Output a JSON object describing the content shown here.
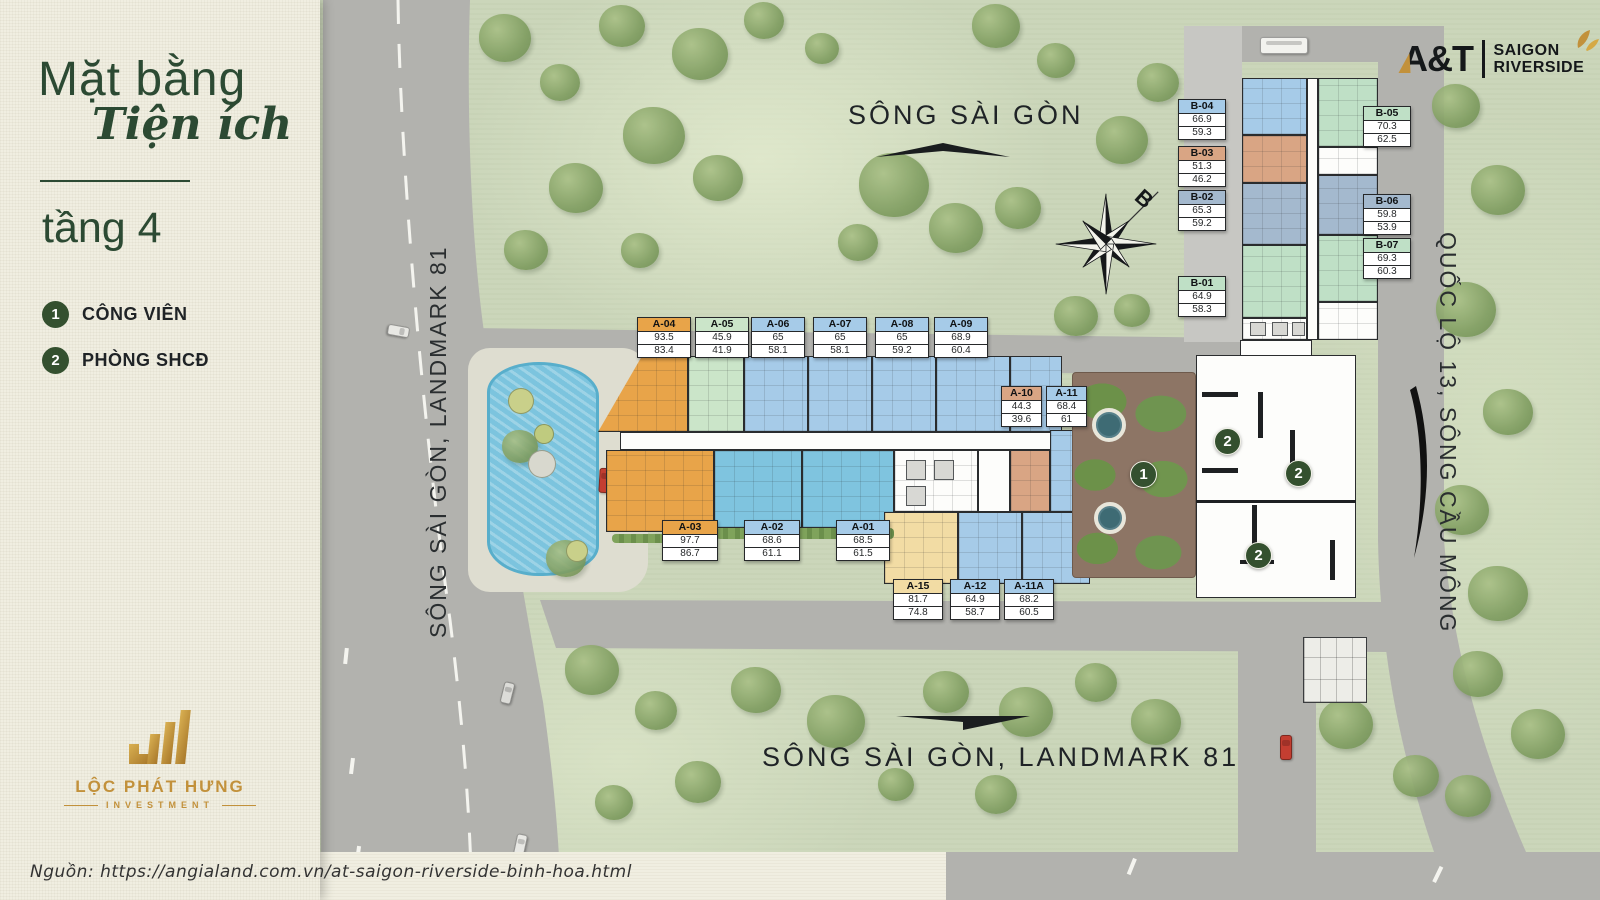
{
  "sidebar": {
    "title_main": "Mặt bằng",
    "title_script": "Tiện ích",
    "floor_label": "tầng 4",
    "legend": [
      {
        "num": "1",
        "label": "CÔNG VIÊN"
      },
      {
        "num": "2",
        "label": "PHÒNG SHCĐ"
      }
    ],
    "brand_name": "LỘC PHÁT HƯNG",
    "brand_sub": "INVESTMENT"
  },
  "source_note": "Nguồn:  https://angialand.com.vn/at-saigon-riverside-binh-hoa.html",
  "project_logo": {
    "mark": "A&T",
    "line1": "SAIGON",
    "line2": "RIVERSIDE"
  },
  "map_labels": {
    "river_top": "SÔNG SÀI GÒN",
    "river_bottom": "SÔNG SÀI GÒN, LANDMARK 81",
    "road_left": "SÔNG SÀI GÒN, LANDMARK 81",
    "road_right": "QUỐC LỘ 13, SÔNG CẦU MÔNG",
    "compass_north": "B"
  },
  "map_badges": [
    "1",
    "2",
    "2",
    "2"
  ],
  "units": [
    {
      "id": "A-04",
      "area1": "93.5",
      "area2": "83.4",
      "color": "orange"
    },
    {
      "id": "A-05",
      "area1": "45.9",
      "area2": "41.9",
      "color": "green"
    },
    {
      "id": "A-06",
      "area1": "65",
      "area2": "58.1",
      "color": "blue"
    },
    {
      "id": "A-07",
      "area1": "65",
      "area2": "58.1",
      "color": "blue"
    },
    {
      "id": "A-08",
      "area1": "65",
      "area2": "59.2",
      "color": "blue"
    },
    {
      "id": "A-09",
      "area1": "68.9",
      "area2": "60.4",
      "color": "blue"
    },
    {
      "id": "A-10",
      "area1": "44.3",
      "area2": "39.6",
      "color": "tan"
    },
    {
      "id": "A-11",
      "area1": "68.4",
      "area2": "61",
      "color": "blue"
    },
    {
      "id": "A-03",
      "area1": "97.7",
      "area2": "86.7",
      "color": "orange"
    },
    {
      "id": "A-02",
      "area1": "68.6",
      "area2": "61.1",
      "color": "blue"
    },
    {
      "id": "A-01",
      "area1": "68.5",
      "area2": "61.5",
      "color": "blue"
    },
    {
      "id": "A-15",
      "area1": "81.7",
      "area2": "74.8",
      "color": "cream"
    },
    {
      "id": "A-12",
      "area1": "64.9",
      "area2": "58.7",
      "color": "blue"
    },
    {
      "id": "A-11A",
      "area1": "68.2",
      "area2": "60.5",
      "color": "blue"
    },
    {
      "id": "B-04",
      "area1": "66.9",
      "area2": "59.3",
      "color": "blue"
    },
    {
      "id": "B-03",
      "area1": "51.3",
      "area2": "46.2",
      "color": "tan"
    },
    {
      "id": "B-02",
      "area1": "65.3",
      "area2": "59.2",
      "color": "bluegray"
    },
    {
      "id": "B-01",
      "area1": "64.9",
      "area2": "58.3",
      "color": "mint"
    },
    {
      "id": "B-05",
      "area1": "70.3",
      "area2": "62.5",
      "color": "mint"
    },
    {
      "id": "B-06",
      "area1": "59.8",
      "area2": "53.9",
      "color": "bluegray"
    },
    {
      "id": "B-07",
      "area1": "69.3",
      "area2": "60.3",
      "color": "mint"
    }
  ],
  "colors": {
    "accent_green": "#34502F",
    "title_green": "#2C4A33",
    "gold": "#C2913B",
    "orange": "#E8A449",
    "green": "#CBE5C9",
    "blue": "#A6CBE8",
    "cyan": "#7FC4DF",
    "tan": "#D9A584",
    "cream": "#F2DCA4",
    "bluegray": "#A4B9CE",
    "mint": "#BFE0C6",
    "white": "#FDFDFB",
    "gray": "#D8D8D4",
    "map_green": "#CBD6BA",
    "road_gray": "#B2B2AE",
    "pool_blue": "#7CC4DE",
    "park_ground": "#8D7565",
    "paper_cream": "#F0EEE1"
  }
}
